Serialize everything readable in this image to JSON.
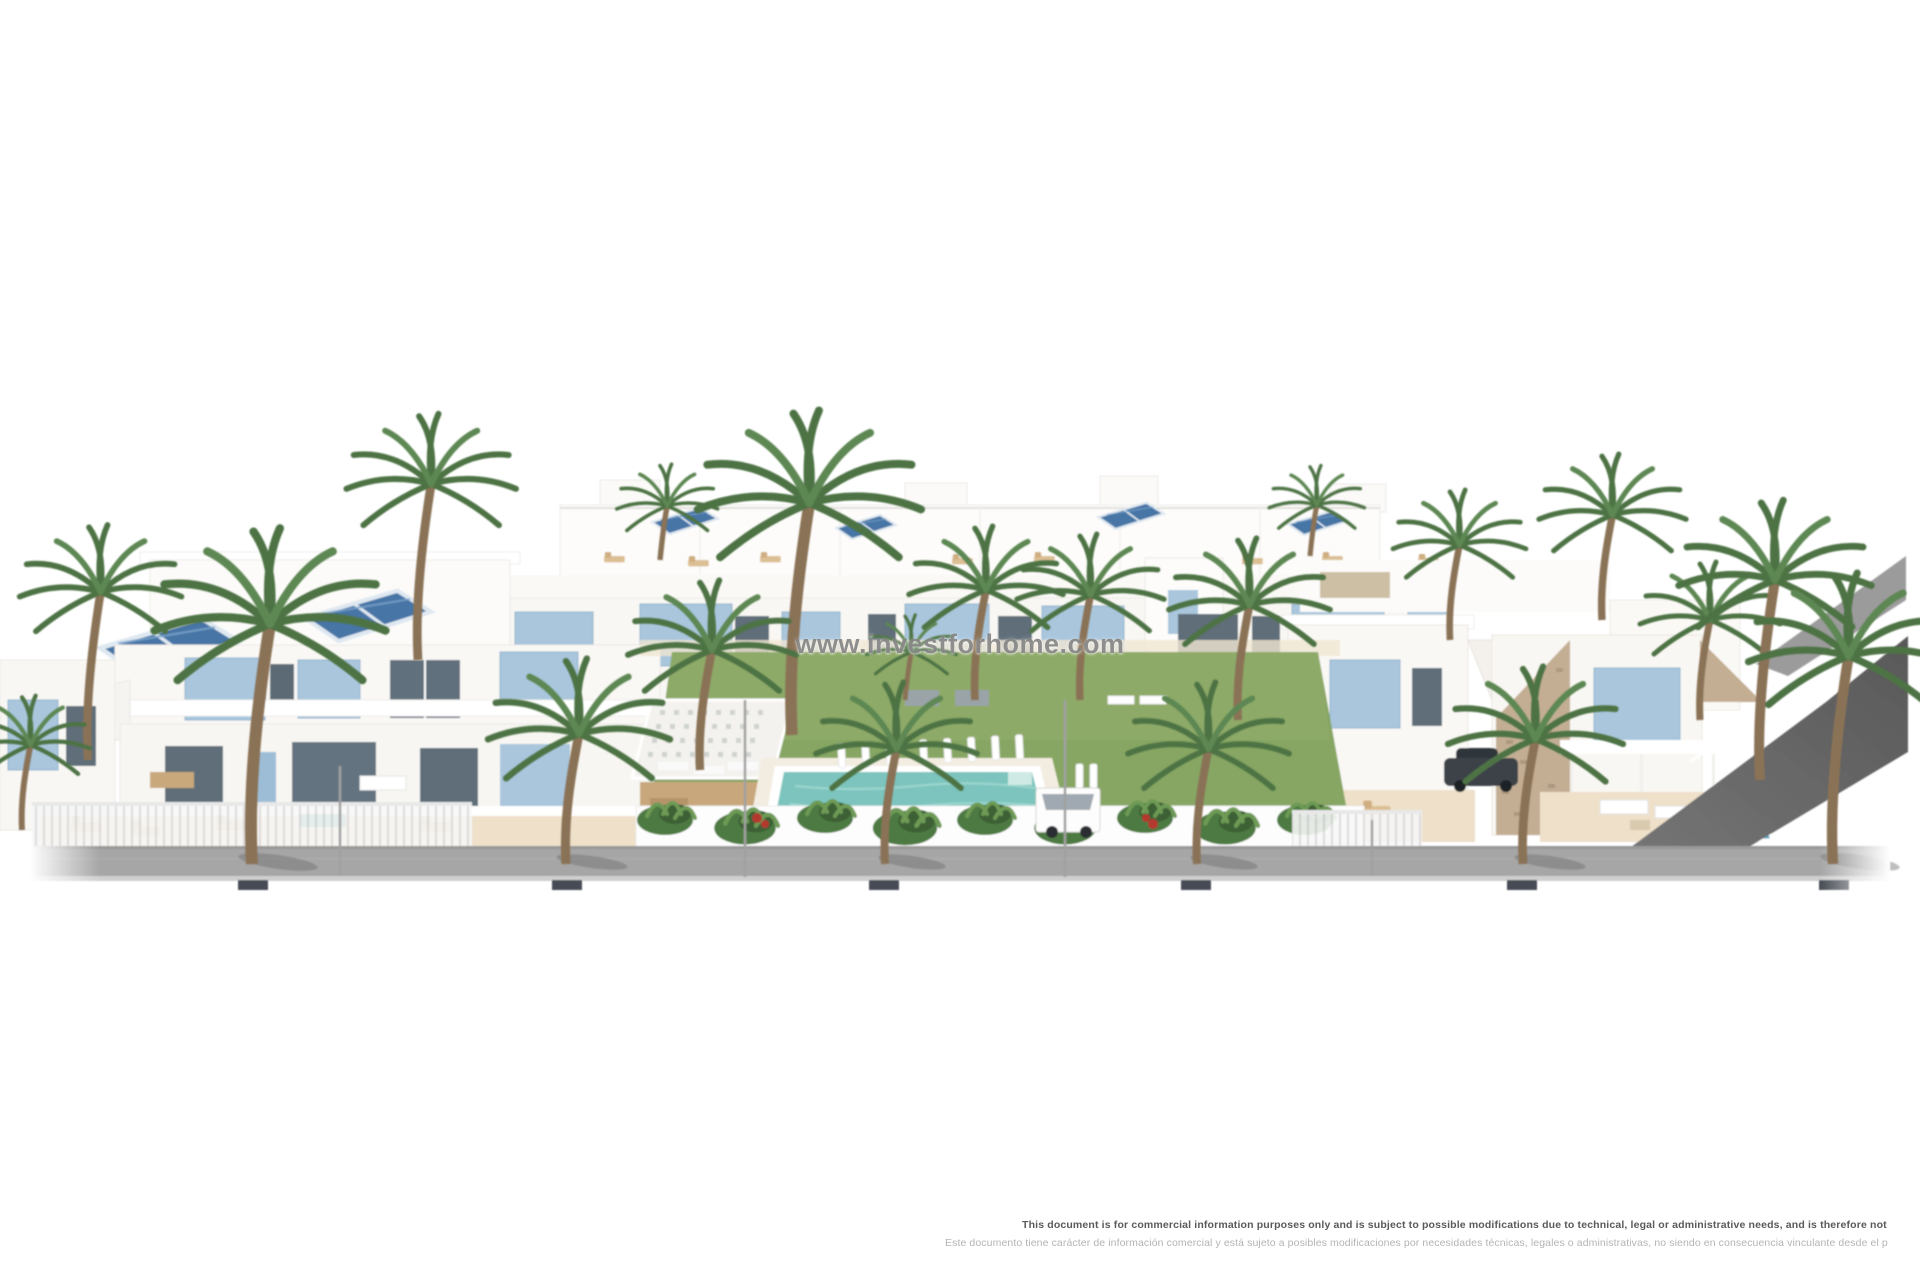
{
  "watermark": {
    "text": "www.investforhome.com",
    "color": "#808080"
  },
  "disclaimer": {
    "en": "This document is for commercial information purposes only and is subject to possible modifications due to technical, legal or administrative needs, and is therefore not",
    "es": "Este documento tiene carácter de información comercial y está sujeto a posibles modificaciones por necesidades técnicas, legales o administrativas, no siendo en consecuencia vinculante desde el p",
    "en_color": "#5a5a5a",
    "es_color": "#b4b4b4"
  },
  "scene": {
    "type": "architectural-render",
    "subject": "White Mediterranean residential development with blue shutters, rooftop solar panels, palm trees, communal lawn garden with swimming pool and sun loungers, villas with stone gables on the right, and a gray sidewalk street in front",
    "palette": {
      "background_white": "#ffffff",
      "building_white": "#faf8f5",
      "building_shade": "#e9e6e1",
      "shutter_blue": "#a9c6dd",
      "window_dark": "#5f6e79",
      "solar_panel_blue": "#4675a6",
      "terrace_beige": "#eee0c9",
      "lounger_tan": "#dcbf94",
      "lawn_green": "#87a663",
      "foliage_green": "#4d7345",
      "pool_turquoise": "#7cc4bd",
      "road_gray": "#a6a6a6",
      "ramp_gray": "#6e6e6e",
      "stone_tan": "#c3ae94"
    }
  }
}
